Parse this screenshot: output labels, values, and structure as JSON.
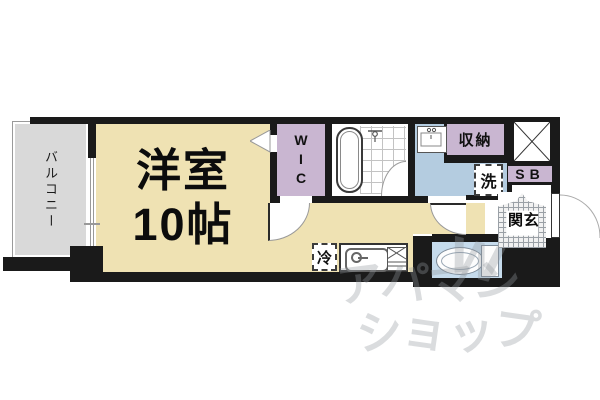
{
  "plan": {
    "main_room": {
      "label_line1": "洋室",
      "label_line2": "10帖"
    },
    "balcony": {
      "label": "バルコニー"
    },
    "wic": {
      "label": "WIC"
    },
    "storage": {
      "label": "収納"
    },
    "shoe_box": {
      "label": "SB"
    },
    "entrance": {
      "label": "玄関"
    },
    "washroom": {
      "washer_label": "洗"
    },
    "kitchen": {
      "fridge_label": "冷"
    }
  },
  "watermark": {
    "line1": "アパマン",
    "line2": "ショップ",
    "mark": "W"
  },
  "colors": {
    "tan": "#EFE2B3",
    "gray": "#D9D9D9",
    "purple": "#C9B6D1",
    "blue": "#B4CCE0",
    "toiletblue": "#C6DBEC",
    "wall": "#1A1A1A",
    "wm": "rgba(148,152,158,0.34)"
  }
}
